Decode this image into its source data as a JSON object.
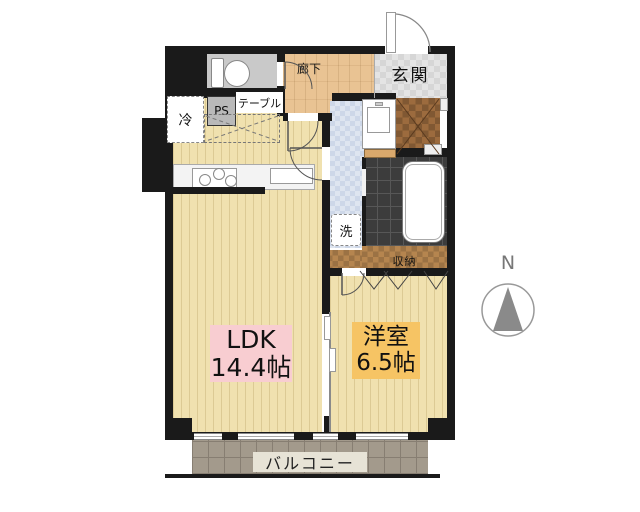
{
  "rooms": {
    "ldk": {
      "name": "LDK",
      "size": "14.4帖"
    },
    "bedroom": {
      "name": "洋室",
      "size": "6.5帖"
    },
    "hallway": {
      "label": "廊下"
    },
    "entrance": {
      "label": "玄関"
    },
    "storage": {
      "label": "収納"
    },
    "balcony": {
      "label": "バルコニー"
    }
  },
  "fixtures": {
    "refrigerator": "冷",
    "pipe_space": "PS",
    "table": "テーブル",
    "washing_machine": "洗"
  },
  "compass": {
    "north": "N"
  },
  "colors": {
    "wall": "#1a1a1a",
    "wood_floor": "#f0e1af",
    "hallway_floor": "#e9c393",
    "entrance_floor": "#d6d6d6",
    "washroom_floor": "#cdd7e8",
    "bathroom_floor": "#3c3c3c",
    "closet_brown": "#9c6b3e",
    "storage_brown": "#b5854f",
    "balcony_gray": "#a39a8c",
    "ldk_label_bg": "#f8cdd1",
    "bedroom_label_bg": "#f6c464",
    "balcony_label_bg": "#e7e3d6"
  }
}
